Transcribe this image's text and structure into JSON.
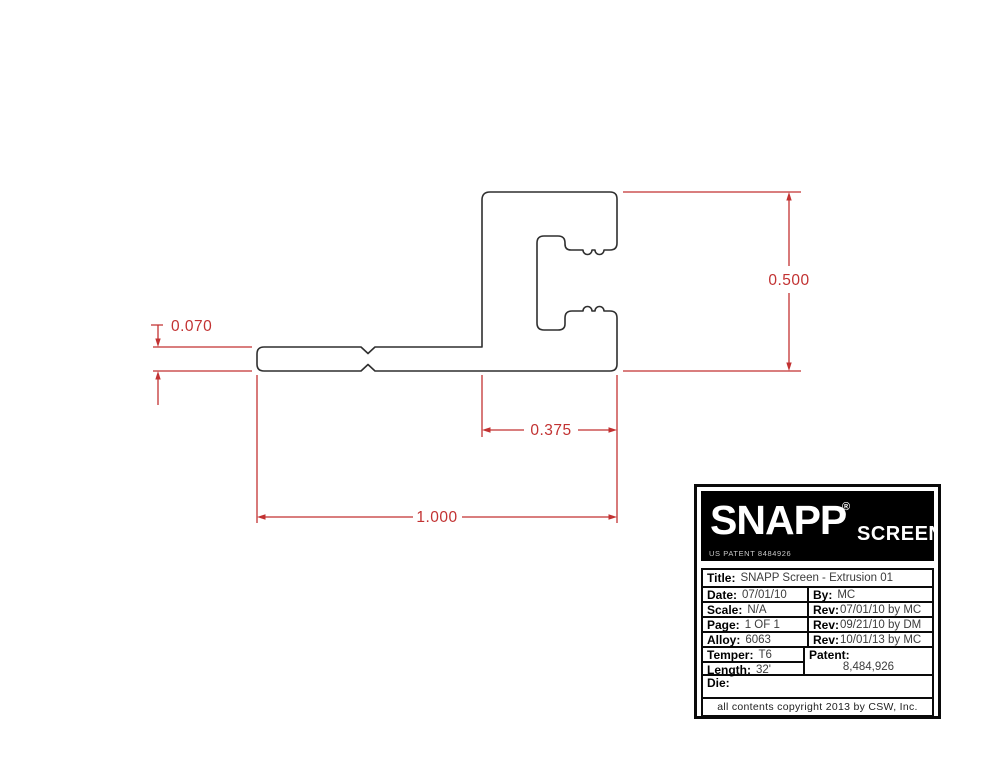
{
  "colors": {
    "outline": "#2f2f2f",
    "dimension_red": "#c23232",
    "logo_bg": "#000000",
    "logo_text": "#ffffff"
  },
  "drawing": {
    "dimension_labels": {
      "overall_height": "0.500",
      "base_thickness": "0.070",
      "clamp_width": "0.375",
      "overall_length": "1.000"
    }
  },
  "title_block": {
    "logo": {
      "brand": "SNAPP",
      "registered_mark": "®",
      "product": "SCREEN",
      "patent_note": "US PATENT 8484926"
    },
    "title": {
      "label": "Title:",
      "value": "SNAPP Screen - Extrusion 01"
    },
    "date": {
      "label": "Date:",
      "value": "07/01/10"
    },
    "by": {
      "label": "By:",
      "value": "MC"
    },
    "scale": {
      "label": "Scale:",
      "value": "N/A"
    },
    "rev1": {
      "label": "Rev:",
      "value": "07/01/10 by MC"
    },
    "page": {
      "label": "Page:",
      "value": "1 OF 1"
    },
    "rev2": {
      "label": "Rev:",
      "value": "09/21/10 by DM"
    },
    "alloy": {
      "label": "Alloy:",
      "value": "6063"
    },
    "rev3": {
      "label": "Rev:",
      "value": "10/01/13 by MC"
    },
    "temper": {
      "label": "Temper:",
      "value": "T6"
    },
    "length": {
      "label": "Length:",
      "value": "32'"
    },
    "patent": {
      "label": "Patent:",
      "value": "8,484,926"
    },
    "die": {
      "label": "Die:",
      "value": ""
    },
    "copyright": "all contents copyright 2013 by CSW, Inc."
  }
}
